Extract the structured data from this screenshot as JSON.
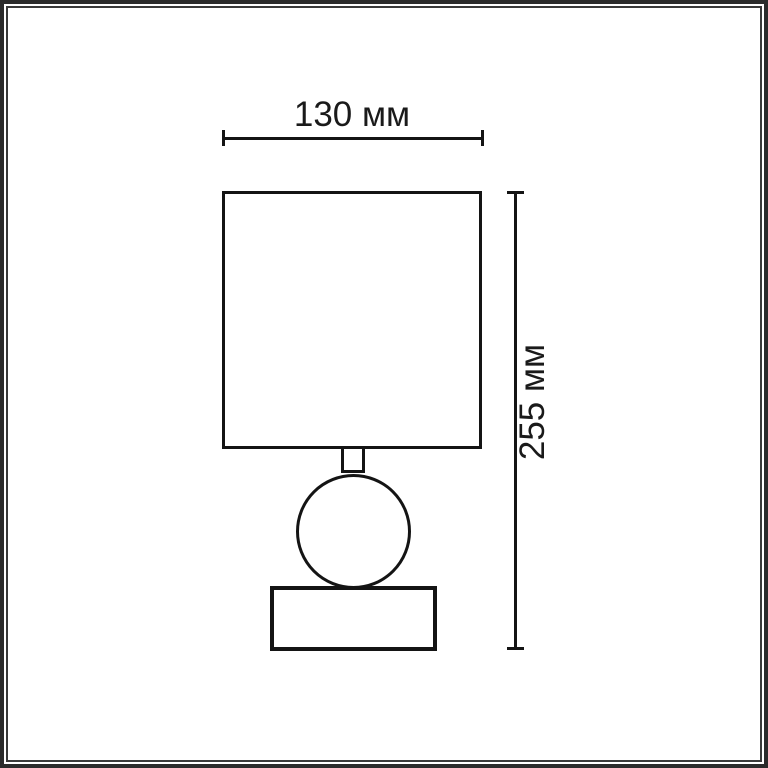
{
  "figure": {
    "width_label": "130 мм",
    "height_label": "255 мм"
  },
  "colors": {
    "line": "#141414",
    "text": "#1a1a1a",
    "frame_outer": "#2b2b2b",
    "frame_inner": "#3a3a3a",
    "background": "#ffffff"
  }
}
